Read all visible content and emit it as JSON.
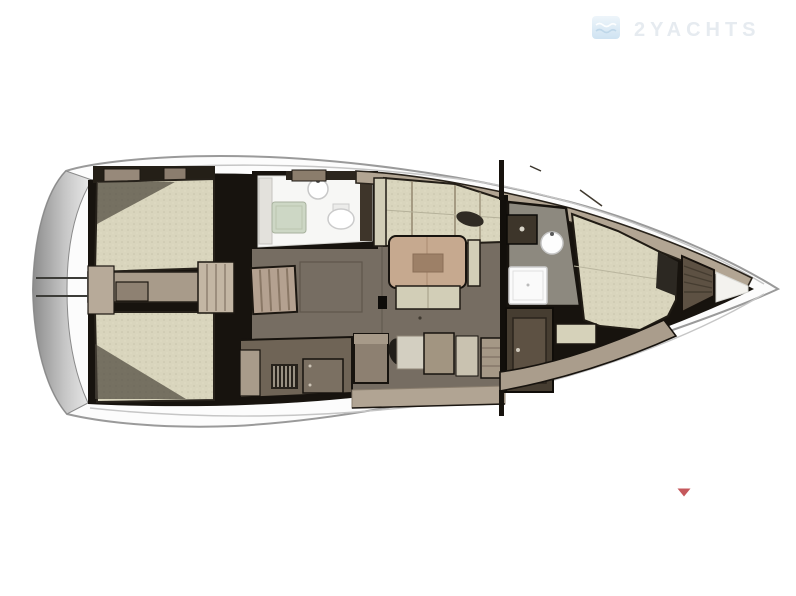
{
  "watermark": {
    "brand": "2YACHTS",
    "icon": "waves-logo-icon",
    "text_color": "#e6ebf0",
    "icon_color_top": "#eef5fa",
    "icon_color_bottom": "#cfe3f2"
  },
  "marker": {
    "shape": "triangle-down",
    "color": "#c5585c"
  },
  "palette": {
    "hull_fill": "#fcfcfc",
    "hull_outline": "#9a9a9a",
    "stern_shadow_dark": "#8d8d8d",
    "stern_shadow_light": "#ececec",
    "interior_dark": "#17130e",
    "cushion_beige": "#d9d5bd",
    "wood_taupe": "#b2a593",
    "wood_dark": "#6f6456",
    "floor_brown": "#766d62",
    "fixture_white": "#f7f7f5",
    "shower_green": "#cdd7c5",
    "table_wood": "#c6a98f",
    "wardrobe_brown": "#5d5143"
  }
}
